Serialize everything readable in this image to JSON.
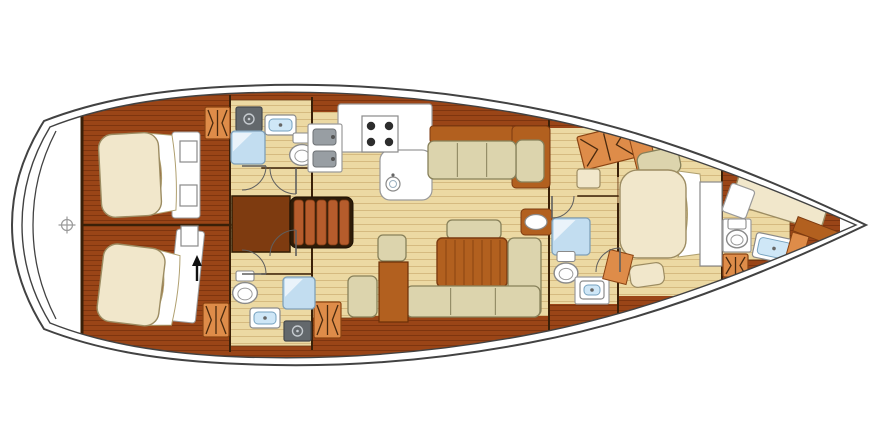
{
  "figure": {
    "type": "yacht-interior-deck-plan",
    "description": "Top-view sailing yacht accommodation layout, bow pointing right: two aft double cabins with heads, central galley and saloon with U-shaped dinette, forward owner cabin with en-suite, forepeak crew cabin",
    "canvas": {
      "width": 890,
      "height": 446,
      "background": "#ffffff"
    },
    "palette": {
      "hull_line": "#424242",
      "wall_line": "#3a2008",
      "floor_light": "#ecd9a3",
      "floor_light_line": "#d5ba80",
      "wood_dark": "#9a4517",
      "wood_dark_line": "#7e350f",
      "wood_mid": "#b2601f",
      "wood_mid_line": "#7c3a10",
      "steps_frame": "#2e1c08",
      "steps_slat": "#b65c2c",
      "wardrobe": "#de8c49",
      "wardrobe_line": "#8a4312",
      "wardrobe_glyph": "#4a2a0e",
      "mattress": "#f1e7cb",
      "mattress_line": "#9c8c62",
      "cushion": "#dcd4ad",
      "cushion_line": "#87805a",
      "fixture_white": "#ffffff",
      "fixture_line": "#8a8a8a",
      "shower_blue": "#c2ddf0",
      "shower_line": "#7fa0b8",
      "sink_blue": "#cfe7f7",
      "sink_line": "#76a2bf",
      "appliance_gray": "#63686c",
      "appliance_detail": "#c6cbd0",
      "burner_dark": "#2d2d2d",
      "door_line": "#5f5f5f",
      "arrow_black": "#111111"
    },
    "hull": {
      "outer": "M 44 121 C 22 156 12 190 12 225 C 12 260 22 294 44 329 C 98 350 160 361 242 364 C 330 368 428 362 528 343 C 630 324 734 288 866 225 C 734 162 630 126 528 107 C 428 88 330 82 242 86 C 160 89 98 100 44 121 Z",
      "inner": "M 50 127 C 30 160 22 192 22 225 C 22 258 30 290 50 323 C 100 343 162 354 242 357 C 328 360 424 354 522 336 C 622 318 724 283 856 225 C 724 167 622 132 522 114 C 424 96 328 90 242 93 C 162 96 100 107 50 127 Z",
      "transom": "M 56 131 C 40 162 33 192 33 225 C 33 258 40 288 56 319",
      "interior": {
        "x": 82,
        "y": 84,
        "w": 758,
        "h": 282
      }
    },
    "floors": [
      {
        "name": "floor-port-head",
        "x": 230,
        "y": 100,
        "w": 82,
        "h": 128
      },
      {
        "name": "floor-main-saloon",
        "x": 312,
        "y": 108,
        "w": 237,
        "h": 210
      },
      {
        "name": "floor-stbd-head",
        "x": 230,
        "y": 228,
        "w": 82,
        "h": 118
      },
      {
        "name": "floor-passage",
        "x": 549,
        "y": 118,
        "w": 69,
        "h": 200
      },
      {
        "name": "floor-owner-cabin",
        "x": 618,
        "y": 132,
        "w": 104,
        "h": 180
      },
      {
        "name": "floor-forepeak",
        "x": 722,
        "y": 206,
        "w": 68,
        "h": 54
      }
    ],
    "bands": [
      {
        "name": "lockers-galley-hull",
        "x": 312,
        "y": 78,
        "w": 248,
        "h": 34
      },
      {
        "name": "lockers-behind-sofa",
        "x": 424,
        "y": 108,
        "w": 126,
        "h": 22
      },
      {
        "name": "lockers-saloon-hull",
        "x": 352,
        "y": 316,
        "w": 197,
        "h": 36
      },
      {
        "name": "lockers-owner-top",
        "x": 618,
        "y": 96,
        "w": 104,
        "h": 50
      },
      {
        "name": "lockers-owner-bottom",
        "x": 618,
        "y": 296,
        "w": 104,
        "h": 42
      },
      {
        "name": "lockers-passage-top",
        "x": 549,
        "y": 94,
        "w": 69,
        "h": 34
      },
      {
        "name": "lockers-midhead-bottom",
        "x": 549,
        "y": 304,
        "w": 69,
        "h": 44
      }
    ],
    "walls": [
      {
        "name": "wall-transom-bulkhead",
        "x1": 82,
        "y1": 118,
        "x2": 82,
        "y2": 332,
        "sw": 3
      },
      {
        "name": "wall-aft-cabins-bulkhead",
        "x1": 230,
        "y1": 96,
        "x2": 230,
        "y2": 351,
        "sw": 2
      },
      {
        "name": "wall-aft-cabin-divider",
        "x1": 82,
        "y1": 225,
        "x2": 230,
        "y2": 225,
        "sw": 2.5
      },
      {
        "name": "wall-heads-bulkhead",
        "x1": 312,
        "y1": 98,
        "x2": 312,
        "y2": 349,
        "sw": 2
      },
      {
        "name": "wall-port-head-south",
        "x1": 262,
        "y1": 168,
        "x2": 312,
        "y2": 168,
        "sw": 1.5
      },
      {
        "name": "wall-stbd-head-north",
        "x1": 262,
        "y1": 274,
        "x2": 312,
        "y2": 274,
        "sw": 1.5
      },
      {
        "name": "wall-saloon-fwd-bulkhead",
        "x1": 549,
        "y1": 102,
        "x2": 549,
        "y2": 344,
        "sw": 2
      },
      {
        "name": "wall-midhead-north",
        "x1": 578,
        "y1": 196,
        "x2": 618,
        "y2": 196,
        "sw": 1.5
      },
      {
        "name": "wall-owner-aft-upper",
        "x1": 618,
        "y1": 126,
        "x2": 618,
        "y2": 176,
        "sw": 2
      },
      {
        "name": "wall-owner-aft-lower",
        "x1": 618,
        "y1": 204,
        "x2": 618,
        "y2": 314,
        "sw": 2
      },
      {
        "name": "wall-forepeak-bulkhead",
        "x1": 722,
        "y1": 158,
        "x2": 722,
        "y2": 290,
        "sw": 2
      }
    ],
    "furniture": [
      {
        "name": "engine-box",
        "kind": "rect",
        "x": 232,
        "y": 196,
        "w": 58,
        "h": 56,
        "fill": "#7e3b10",
        "stroke": "#331e06",
        "sw": 1.5
      },
      {
        "name": "companionway-steps",
        "kind": "steps",
        "x": 290,
        "y": 197,
        "w": 63,
        "h": 51
      },
      {
        "name": "aft-cabin-port-bed-base",
        "kind": "rect",
        "x": 172,
        "y": 132,
        "w": 28,
        "h": 86,
        "fill": "#ffffff",
        "stroke": "#999999",
        "sw": 1,
        "rx": 3
      },
      {
        "name": "aft-cabin-port-bed",
        "kind": "bed",
        "x": 100,
        "y": 133,
        "w": 78,
        "h": 83,
        "rot": -3,
        "fold": "right",
        "rx": 14
      },
      {
        "name": "aft-cabin-port-shelf-a",
        "kind": "rect",
        "x": 180,
        "y": 141,
        "w": 17,
        "h": 21,
        "fill": "#ffffff",
        "stroke": "#8a8a8a",
        "sw": 1.2
      },
      {
        "name": "aft-cabin-port-shelf-b",
        "kind": "rect",
        "x": 180,
        "y": 185,
        "w": 17,
        "h": 21,
        "fill": "#ffffff",
        "stroke": "#8a8a8a",
        "sw": 1.2
      },
      {
        "name": "wardrobe-port-aft",
        "kind": "wardrobe",
        "x": 205,
        "y": 107,
        "w": 25,
        "h": 32
      },
      {
        "name": "aft-cabin-stbd-bed-base",
        "kind": "rect",
        "x": 172,
        "y": 230,
        "w": 28,
        "h": 92,
        "fill": "#ffffff",
        "stroke": "#999999",
        "sw": 1,
        "rx": 3,
        "rot": 6
      },
      {
        "name": "aft-cabin-stbd-bed",
        "kind": "bed",
        "x": 100,
        "y": 247,
        "w": 80,
        "h": 78,
        "rot": 7,
        "fold": "right",
        "rx": 14
      },
      {
        "name": "aft-cabin-stbd-shelf",
        "kind": "rect",
        "x": 181,
        "y": 226,
        "w": 17,
        "h": 20,
        "fill": "#ffffff",
        "stroke": "#8a8a8a",
        "sw": 1.2
      },
      {
        "name": "wardrobe-stbd-aft-a",
        "kind": "wardrobe",
        "x": 203,
        "y": 303,
        "w": 26,
        "h": 34
      },
      {
        "name": "wardrobe-stbd-aft-b",
        "kind": "wardrobe",
        "x": 314,
        "y": 302,
        "w": 27,
        "h": 36
      },
      {
        "name": "companionway-arrow",
        "kind": "arrow",
        "x": 197,
        "y1": 281,
        "y2": 257
      },
      {
        "name": "washer-port-head",
        "kind": "appliance",
        "x": 236,
        "y": 107,
        "w": 26,
        "h": 24
      },
      {
        "name": "sink-port-head",
        "kind": "sink",
        "x": 265,
        "y": 115,
        "w": 31,
        "h": 20
      },
      {
        "name": "shower-port-head",
        "kind": "shower",
        "x": 231,
        "y": 131,
        "w": 34,
        "h": 33
      },
      {
        "name": "toilet-port-head",
        "kind": "toilet",
        "cx": 302,
        "cy": 155,
        "r": 13
      },
      {
        "name": "toilet-stbd-head",
        "kind": "toilet",
        "cx": 245,
        "cy": 293,
        "r": 13
      },
      {
        "name": "sink-stbd-head",
        "kind": "sink",
        "x": 250,
        "y": 308,
        "w": 30,
        "h": 20
      },
      {
        "name": "shower-stbd-head",
        "kind": "shower",
        "x": 283,
        "y": 277,
        "w": 32,
        "h": 32
      },
      {
        "name": "washer-stbd-head",
        "kind": "appliance",
        "x": 284,
        "y": 321,
        "w": 27,
        "h": 20
      },
      {
        "name": "galley-counter",
        "kind": "rect",
        "x": 338,
        "y": 104,
        "w": 94,
        "h": 48,
        "fill": "#ffffff",
        "stroke": "#9a9a9a",
        "sw": 1.2,
        "rx": 3
      },
      {
        "name": "galley-counter-return",
        "kind": "rect",
        "x": 380,
        "y": 150,
        "w": 52,
        "h": 50,
        "fill": "#ffffff",
        "stroke": "#9a9a9a",
        "sw": 1.2,
        "rx": 10
      },
      {
        "name": "galley-stove",
        "kind": "stove",
        "x": 362,
        "y": 116,
        "w": 36,
        "h": 36
      },
      {
        "name": "galley-round-sink",
        "kind": "circlesink",
        "cx": 393,
        "cy": 184,
        "r": 7
      },
      {
        "name": "galley-twin-sink",
        "kind": "dblsink",
        "x": 308,
        "y": 124,
        "w": 34,
        "h": 48
      },
      {
        "name": "saloon-sofa-port-backrest",
        "kind": "rect",
        "x": 430,
        "y": 126,
        "w": 84,
        "h": 17,
        "fill": "wood_mid",
        "stroke": "wood_mid_line",
        "sw": 1,
        "rx": 3
      },
      {
        "name": "saloon-sofa-corner",
        "kind": "rect",
        "x": 512,
        "y": 126,
        "w": 38,
        "h": 62,
        "fill": "wood_mid",
        "stroke": "wood_mid_line",
        "sw": 1,
        "rx": 4
      },
      {
        "name": "saloon-sofa-corner-cushion",
        "kind": "rect",
        "x": 516,
        "y": 140,
        "w": 28,
        "h": 42,
        "fill": "cushion",
        "stroke": "cushion_line",
        "sw": 1.3,
        "rx": 6
      },
      {
        "name": "saloon-sofa-port",
        "kind": "sofa",
        "x": 428,
        "y": 141,
        "w": 88,
        "h": 38,
        "segs": 3
      },
      {
        "name": "saloon-bench-back-cushion",
        "kind": "rect",
        "x": 447,
        "y": 220,
        "w": 54,
        "h": 19,
        "fill": "cushion",
        "stroke": "cushion_line",
        "sw": 1.3,
        "rx": 5
      },
      {
        "name": "wet-bar",
        "kind": "rect",
        "x": 521,
        "y": 209,
        "w": 31,
        "h": 26,
        "fill": "wood_mid",
        "stroke": "wood_mid_line",
        "sw": 1,
        "rx": 4
      },
      {
        "name": "wet-bar-basin",
        "kind": "ellipse",
        "cx": 536,
        "cy": 222,
        "rx": 11,
        "ry": 7.5,
        "fill": "#ffffff",
        "stroke": "#8a8a8a",
        "sw": 1.2
      },
      {
        "name": "saloon-table",
        "kind": "table",
        "x": 437,
        "y": 238,
        "w": 70,
        "h": 49
      },
      {
        "name": "saloon-sofa-stbd-side",
        "kind": "rect",
        "x": 508,
        "y": 238,
        "w": 33,
        "h": 78,
        "fill": "cushion",
        "stroke": "cushion_line",
        "sw": 1.3,
        "rx": 6
      },
      {
        "name": "saloon-sofa-stbd",
        "kind": "sofa",
        "x": 406,
        "y": 286,
        "w": 134,
        "h": 31,
        "segs": 3
      },
      {
        "name": "saloon-seat",
        "kind": "rect",
        "x": 378,
        "y": 235,
        "w": 28,
        "h": 26,
        "fill": "cushion",
        "stroke": "cushion_line",
        "sw": 1.3,
        "rx": 5
      },
      {
        "name": "saloon-cabinet",
        "kind": "rect",
        "x": 379,
        "y": 262,
        "w": 29,
        "h": 60,
        "fill": "wood_mid",
        "stroke": "#6b3008",
        "sw": 1.2
      },
      {
        "name": "nav-seat",
        "kind": "rect",
        "x": 348,
        "y": 276,
        "w": 29,
        "h": 41,
        "fill": "cushion",
        "stroke": "cushion_line",
        "sw": 1.3,
        "rx": 6
      },
      {
        "name": "shower-mid-head",
        "kind": "shower",
        "x": 552,
        "y": 218,
        "w": 38,
        "h": 37
      },
      {
        "name": "toilet-mid-head",
        "kind": "toilet",
        "cx": 566,
        "cy": 273,
        "r": 12.5
      },
      {
        "name": "vanity-mid-head",
        "kind": "rect",
        "x": 575,
        "y": 277,
        "w": 34,
        "h": 27,
        "fill": "#ffffff",
        "stroke": "#9a9a9a",
        "sw": 1.2,
        "rx": 2
      },
      {
        "name": "sink-mid-head",
        "kind": "sink",
        "x": 580,
        "y": 281,
        "w": 24,
        "h": 18
      },
      {
        "name": "wardrobe-owner",
        "kind": "wardrobe",
        "x": 580,
        "y": 130,
        "w": 54,
        "h": 34,
        "rot": -14
      },
      {
        "name": "owner-locker",
        "kind": "rect",
        "x": 633,
        "y": 136,
        "w": 20,
        "h": 32,
        "fill": "wardrobe",
        "stroke": "wardrobe_line",
        "sw": 1,
        "rot": -14
      },
      {
        "name": "owner-seat-aft",
        "kind": "rect",
        "x": 577,
        "y": 169,
        "w": 23,
        "h": 19,
        "fill": "mattress",
        "stroke": "mattress_line",
        "sw": 1.2,
        "rx": 3
      },
      {
        "name": "owner-seat-top",
        "kind": "rect",
        "x": 638,
        "y": 150,
        "w": 42,
        "h": 26,
        "fill": "cushion",
        "stroke": "cushion_line",
        "sw": 1.3,
        "rx": 8,
        "rot": -12
      },
      {
        "name": "owner-bed",
        "kind": "bed",
        "x": 620,
        "y": 170,
        "w": 84,
        "h": 88,
        "rot": 0,
        "fold": "right",
        "rx": 18
      },
      {
        "name": "owner-nightstand-a",
        "kind": "rect",
        "x": 702,
        "y": 186,
        "w": 18,
        "h": 24,
        "fill": "#ffffff",
        "stroke": "#8a8a8a",
        "sw": 1.2
      },
      {
        "name": "owner-nightstand-b",
        "kind": "rect",
        "x": 702,
        "y": 228,
        "w": 18,
        "h": 24,
        "fill": "#ffffff",
        "stroke": "#8a8a8a",
        "sw": 1.2
      },
      {
        "name": "owner-seat-fwd",
        "kind": "rect",
        "x": 630,
        "y": 264,
        "w": 34,
        "h": 22,
        "fill": "mattress",
        "stroke": "mattress_line",
        "sw": 1.2,
        "rx": 7,
        "rot": -8
      },
      {
        "name": "owner-step",
        "kind": "rect",
        "x": 606,
        "y": 252,
        "w": 24,
        "h": 30,
        "fill": "wardrobe",
        "stroke": "wardrobe_line",
        "sw": 1,
        "rot": 14
      },
      {
        "name": "forepeak-door-panel",
        "kind": "rect",
        "x": 700,
        "y": 182,
        "w": 22,
        "h": 84,
        "fill": "#ffffff",
        "stroke": "#8a8a8a",
        "sw": 1.2
      },
      {
        "name": "forepeak-berth",
        "kind": "bed",
        "x": 734,
        "y": 180,
        "w": 94,
        "h": 38,
        "rot": 17,
        "fold": "none",
        "rx": 8
      },
      {
        "name": "forepeak-pillow",
        "kind": "rect",
        "x": 726,
        "y": 186,
        "w": 25,
        "h": 30,
        "fill": "#ffffff",
        "stroke": "#9a9a9a",
        "sw": 1.2,
        "rot": 20,
        "rx": 3
      },
      {
        "name": "forepeak-vanity",
        "kind": "rect",
        "x": 723,
        "y": 219,
        "w": 28,
        "h": 33,
        "fill": "#ffffff",
        "stroke": "#9a9a9a",
        "sw": 1.2,
        "rx": 2
      },
      {
        "name": "toilet-forepeak",
        "kind": "toilet",
        "cx": 737,
        "cy": 239,
        "r": 11
      },
      {
        "name": "sink-forepeak",
        "kind": "sink",
        "x": 754,
        "y": 236,
        "w": 40,
        "h": 25,
        "rot": 12
      },
      {
        "name": "wardrobe-forepeak",
        "kind": "wardrobe",
        "x": 723,
        "y": 254,
        "w": 25,
        "h": 23
      },
      {
        "name": "forepeak-locker",
        "kind": "rect",
        "x": 789,
        "y": 234,
        "w": 17,
        "h": 24,
        "fill": "wardrobe",
        "stroke": "wardrobe_line",
        "sw": 1,
        "rot": 16
      },
      {
        "name": "bow-shelf",
        "kind": "rect",
        "x": 794,
        "y": 224,
        "w": 44,
        "h": 15,
        "fill": "wood_mid",
        "stroke": "wood_mid_line",
        "sw": 1,
        "rot": 21
      }
    ],
    "doors": [
      {
        "name": "door-port-head",
        "hx": 242,
        "hy": 166,
        "r": 24,
        "a0": 90,
        "a1": 0
      },
      {
        "name": "door-port-cabin",
        "hx": 296,
        "hy": 168,
        "r": 26,
        "a0": 180,
        "a1": 90
      },
      {
        "name": "door-stbd-head",
        "hx": 242,
        "hy": 274,
        "r": 24,
        "a0": 270,
        "a1": 360
      },
      {
        "name": "door-stbd-cabin",
        "hx": 296,
        "hy": 256,
        "r": 26,
        "a0": 180,
        "a1": 270
      },
      {
        "name": "door-mid-head",
        "hx": 552,
        "hy": 196,
        "r": 22,
        "a0": 0,
        "a1": 90
      },
      {
        "name": "door-owner-cabin",
        "hx": 620,
        "hy": 272,
        "r": 24,
        "a0": 180,
        "a1": 270
      }
    ],
    "symbols": {
      "stern-crosshair": {
        "cx": 67,
        "cy": 225,
        "r": 5.5
      }
    }
  }
}
